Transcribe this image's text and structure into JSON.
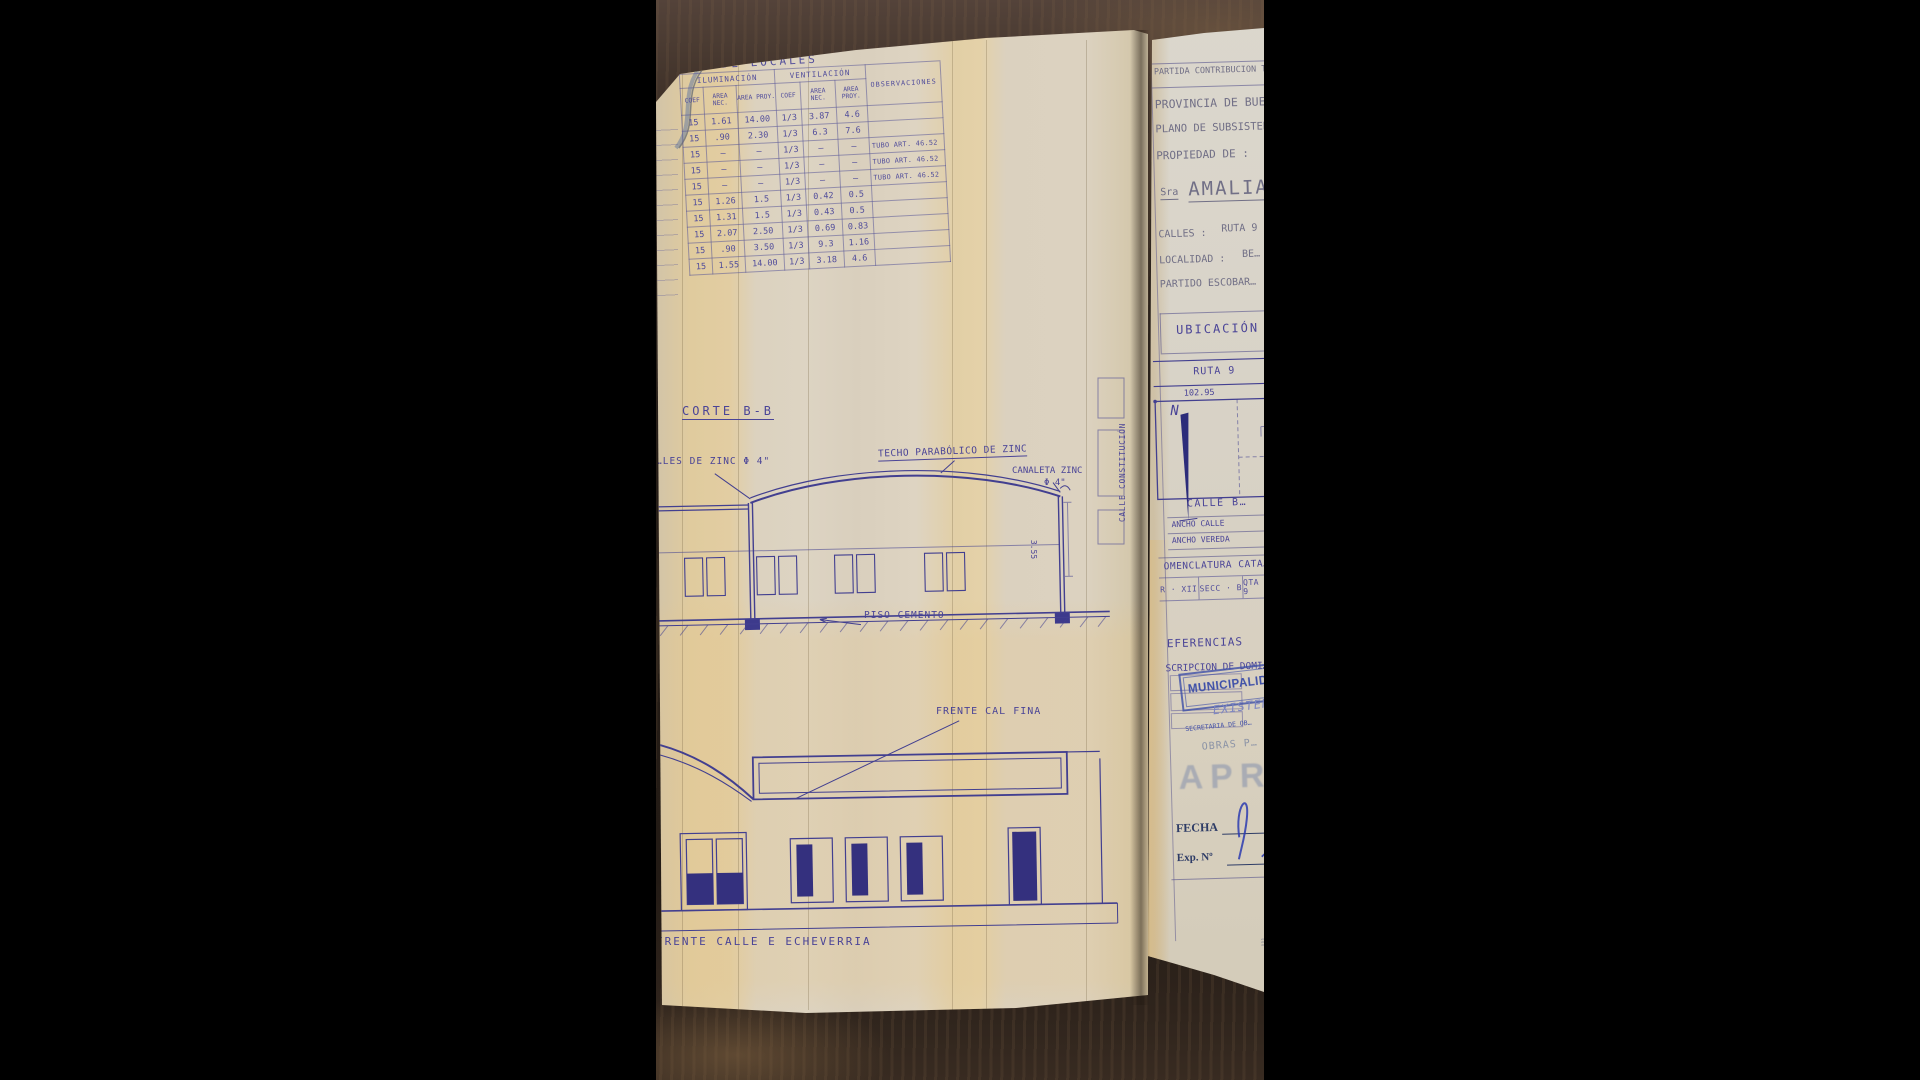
{
  "planilla": {
    "title": "…A DE LOCALES",
    "groups": {
      "iluminacion": "ILUMINACIÓN",
      "ventilacion": "VENTILACIÓN",
      "observaciones": "OBSERVACIONES"
    },
    "col_headers": [
      "COEF",
      "AREA NEC.",
      "AREA PROY.",
      "COEF",
      "AREA NEC.",
      "AREA PROY."
    ],
    "rows": [
      [
        "15",
        "1.61",
        "14.00",
        "1/3",
        "3.87",
        "4.6",
        ""
      ],
      [
        "15",
        ".90",
        "2.30",
        "1/3",
        "6.3",
        "7.6",
        ""
      ],
      [
        "15",
        "—",
        "—",
        "1/3",
        "—",
        "—",
        "TUBO ART. 46.52"
      ],
      [
        "15",
        "—",
        "—",
        "1/3",
        "—",
        "—",
        "TUBO ART. 46.52"
      ],
      [
        "15",
        "—",
        "—",
        "1/3",
        "—",
        "—",
        "TUBO ART. 46.52"
      ],
      [
        "15",
        "1.26",
        "1.5",
        "1/3",
        "0.42",
        "0.5",
        ""
      ],
      [
        "15",
        "1.31",
        "1.5",
        "1/3",
        "0.43",
        "0.5",
        ""
      ],
      [
        "15",
        "2.07",
        "2.50",
        "1/3",
        "0.69",
        "0.83",
        ""
      ],
      [
        "15",
        ".90",
        "3.50",
        "1/3",
        "9.3",
        "1.16",
        ""
      ],
      [
        "15",
        "1.55",
        "14.00",
        "1/3",
        "3.18",
        "4.6",
        ""
      ]
    ]
  },
  "corte": {
    "title": "CORTE B-B",
    "zinc_left": "…LES DE ZINC Φ 4\"",
    "techo": "TECHO PARABÓLICO DE ZINC",
    "canaleta": "CANALETA ZINC",
    "canaleta_dia": "Φ 4\"",
    "piso": "PISO CEMENTO",
    "dim_alto": "3.55"
  },
  "frente": {
    "cal_fina": "FRENTE CAL FINA",
    "calle": "FRENTE CALLE  E  ECHEVERRIA"
  },
  "caratula": {
    "partida": "PARTIDA CONTRIBUCION T…",
    "provincia": "PROVINCIA DE BUEN…",
    "plano": "PLANO DE SUBSISTENC…",
    "propiedad": "PROPIEDAD DE :",
    "titular_prefijo": "Sra",
    "titular": "AMALIA",
    "calles_label": "CALLES :",
    "calles_valor": "RUTA 9",
    "localidad_label": "LOCALIDAD :",
    "localidad_valor": "BE…",
    "partido": "PARTIDO ESCOBAR…"
  },
  "ubicacion": {
    "title": "UBICACIÓN",
    "ruta": "RUTA 9",
    "frente_dim": "102.95",
    "norte": "N",
    "calle_izquierda": "CALLE CONSTITUCIÓN",
    "calle_abajo": "CALLE B…",
    "ancho_calle": "ANCHO CALLE",
    "ancho_vereda": "ANCHO VEREDA"
  },
  "nomenclatura": {
    "title": "OMENCLATURA CATA…",
    "circ": "R · XII",
    "secc": "SECC · B",
    "qta": "QTA · 9"
  },
  "referencias": {
    "title": "EFERENCIAS",
    "inscripcion": "SCRIPCION DE DOMI…"
  },
  "sellos": {
    "municipalidad": "MUNICIPALID…",
    "existente": "EXISTEN…",
    "secretaria": "SECRETARIA DE OB…",
    "obras": "OBRAS P…",
    "aprobado": "APR",
    "fecha": "FECHA",
    "exp": "Exp. Nº"
  }
}
